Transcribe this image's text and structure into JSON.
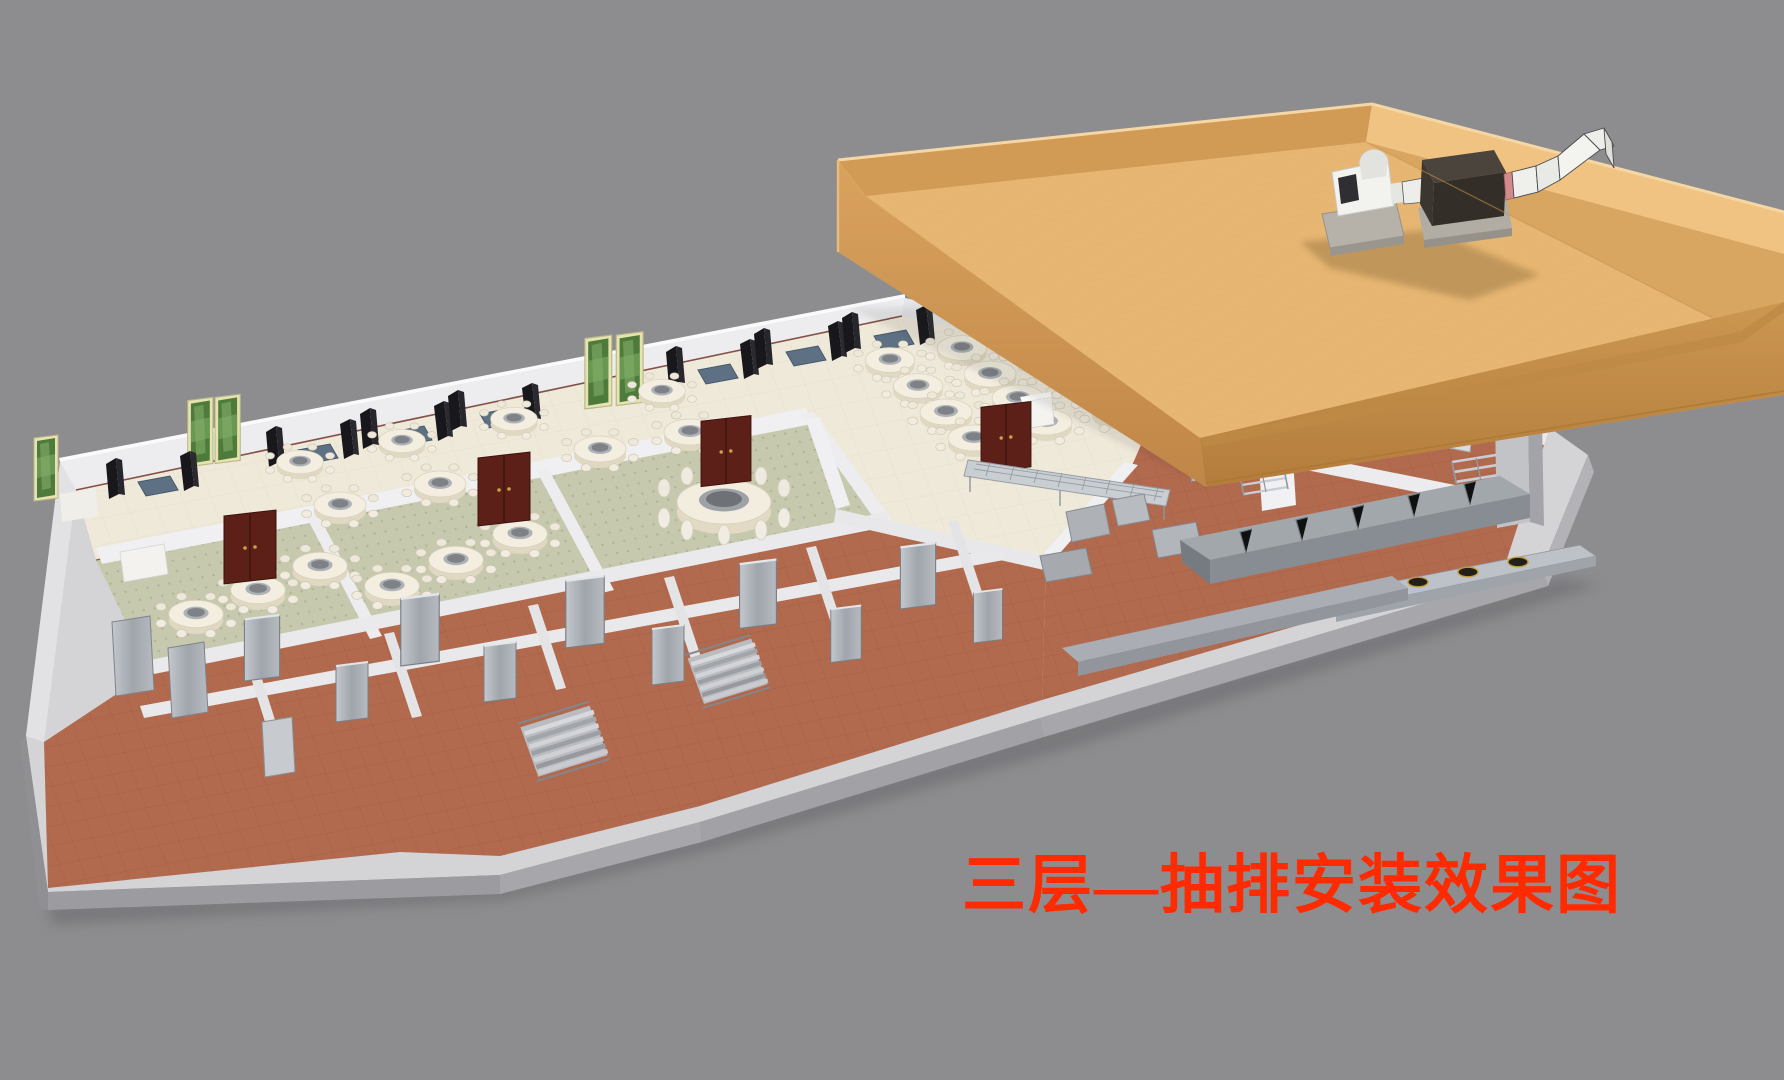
{
  "title": {
    "text": "三层—抽排安装效果图",
    "meaning": "Third floor — exhaust installation rendering",
    "color": "#FF2B00"
  },
  "scene": {
    "background_color": "#8D8D90",
    "roof": {
      "name": "rooftop-slab",
      "top_color": "#E3B26E",
      "fascia_color": "#C99350",
      "parapet_inner_left": "#D19A55",
      "parapet_inner_right": "#F0C383",
      "equipment": [
        {
          "name": "exhaust-fan-unit",
          "color": "#F2F2EF"
        },
        {
          "name": "silencer-box",
          "color": "#3B352E"
        },
        {
          "name": "duct-run",
          "color": "#EDEDEA"
        },
        {
          "name": "duct-elbow-over-parapet",
          "color": "#F3F3F0"
        },
        {
          "name": "concrete-pads",
          "color": "#B7B2A9"
        },
        {
          "name": "flex-connector",
          "color": "#D4898C"
        }
      ]
    },
    "floor": {
      "dining_floor_color": "#EFE9DA",
      "vip_carpet_color": "#C6C9AE",
      "tile_floor_color": "#B26A4E",
      "wall_color": "#ECECEF",
      "slab_color": "#D4D4D7",
      "areas": [
        "dining-hall",
        "vip-rooms",
        "banquet-room",
        "kitchen",
        "service-corridor",
        "stair-halls"
      ],
      "furniture": [
        {
          "name": "round-banquet-table",
          "count": 25
        },
        {
          "name": "large-vip-table",
          "count": 1
        },
        {
          "name": "booth-seating",
          "count": 7
        },
        {
          "name": "landscape-picture",
          "count": 5
        },
        {
          "name": "wooden-double-door",
          "count": 4,
          "color": "#5D2019"
        },
        {
          "name": "metal-door",
          "count": 10
        },
        {
          "name": "staircase",
          "count": 2
        },
        {
          "name": "exhaust-hood-line",
          "count": 1
        },
        {
          "name": "wok-cooking-line",
          "count": 1
        },
        {
          "name": "stainless-racks",
          "count": 5
        },
        {
          "name": "pass-through-counter",
          "count": 1
        }
      ]
    }
  }
}
